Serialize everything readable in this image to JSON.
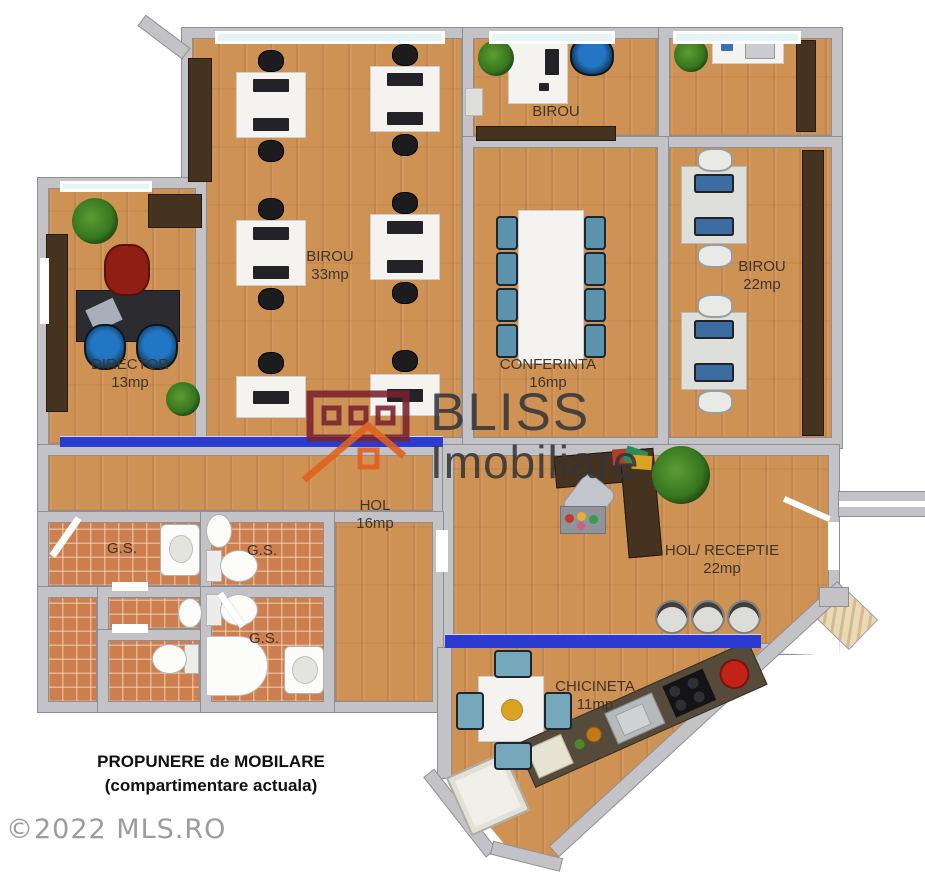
{
  "watermark": {
    "brand": "BLISS",
    "brand_sub": "Imobiliare"
  },
  "footer": {
    "title_line1": "PROPUNERE de MOBILARE",
    "title_line2": "(compartimentare actuala)",
    "copyright": "©2022 MLS.RO"
  },
  "rooms": [
    {
      "id": "birou-top",
      "label": "BIROU",
      "area": ""
    },
    {
      "id": "birou-33",
      "label": "BIROU",
      "area": "33mp"
    },
    {
      "id": "birou-22",
      "label": "BIROU",
      "area": "22mp"
    },
    {
      "id": "conferinta",
      "label": "CONFERINTA",
      "area": "16mp"
    },
    {
      "id": "director",
      "label": "DIRECTOR",
      "area": "13mp"
    },
    {
      "id": "hol",
      "label": "HOL",
      "area": "16mp"
    },
    {
      "id": "gs-left",
      "label": "G.S.",
      "area": ""
    },
    {
      "id": "gs-right-top",
      "label": "G.S.",
      "area": ""
    },
    {
      "id": "gs-right-bottom",
      "label": "G.S.",
      "area": ""
    },
    {
      "id": "receptie",
      "label": "HOL/ RECEPTIE",
      "area": "22mp"
    },
    {
      "id": "chicineta",
      "label": "CHICINETA",
      "area": "11mp"
    }
  ],
  "colors": {
    "wall": "#c3c3c7",
    "wall-edge": "#8f8f93",
    "wood": "#cf9255",
    "tile": "#cd7f4f",
    "dark-wood": "#46331f",
    "mat-blue": "#2b3bd0",
    "window-glass": "#e4f4f7",
    "chair-blue": "#1b66ad",
    "chair-teal": "#5d92ac",
    "chair-red": "#8f1e14",
    "logo-red": "#7a222e",
    "logo-orange": "#e2601c",
    "watermark-text": "#35353a",
    "label-text": "#40342a",
    "title-text": "#111111",
    "copyright-text": "#9c9c9c"
  }
}
